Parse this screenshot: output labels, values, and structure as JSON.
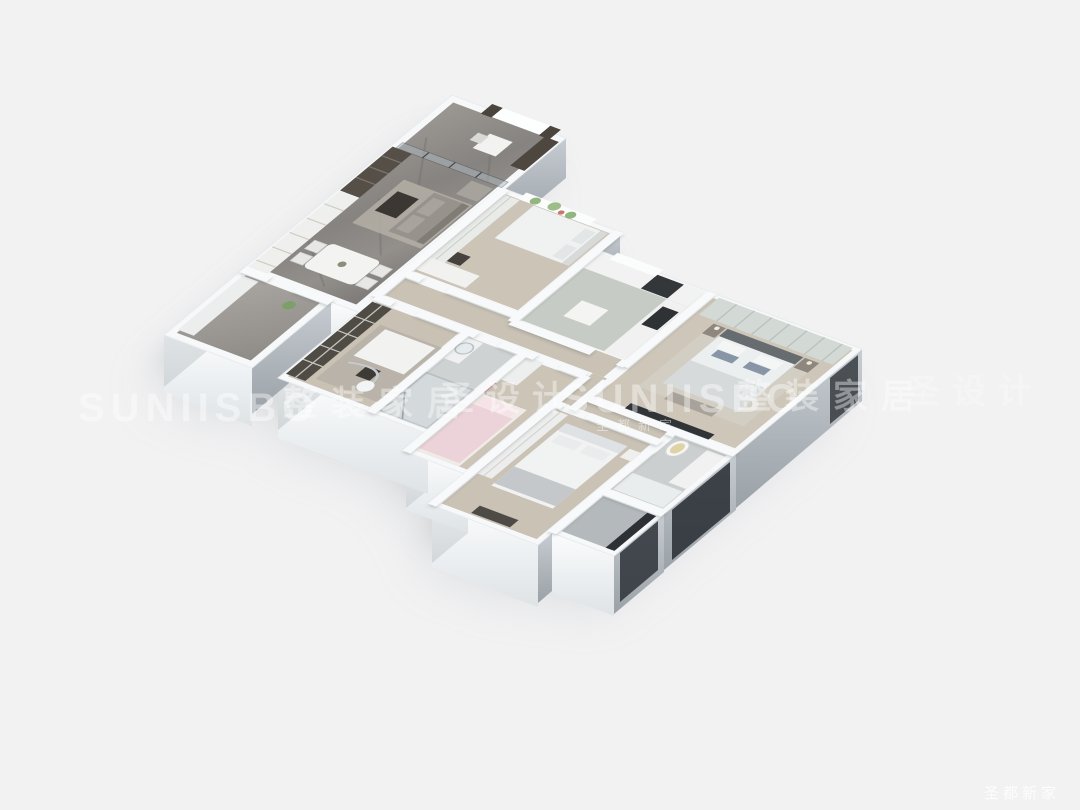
{
  "watermarks": {
    "brand": "SUNIISBO",
    "tagline_home": "整装家居",
    "tagline_design": "圣设计",
    "brand_sub": "圣都新家",
    "corner": "圣都新家"
  },
  "palette": {
    "background": "#f2f2f3",
    "wall_white": "#f6f8f9",
    "marble_floor": "#8b8783",
    "wood_floor": "#cbc4b7",
    "kitchen_floor": "#c6cbc5",
    "bath_floor": "#ced2d3",
    "glass": "#aeb9c0",
    "dark_wood": "#4c473f",
    "sofa_gray": "#97938c",
    "pillow_blue": "#8795a6",
    "kids_pink": "#ecd3d9",
    "window_glazing": "#2e3338",
    "shadow": "#a6abb0"
  }
}
